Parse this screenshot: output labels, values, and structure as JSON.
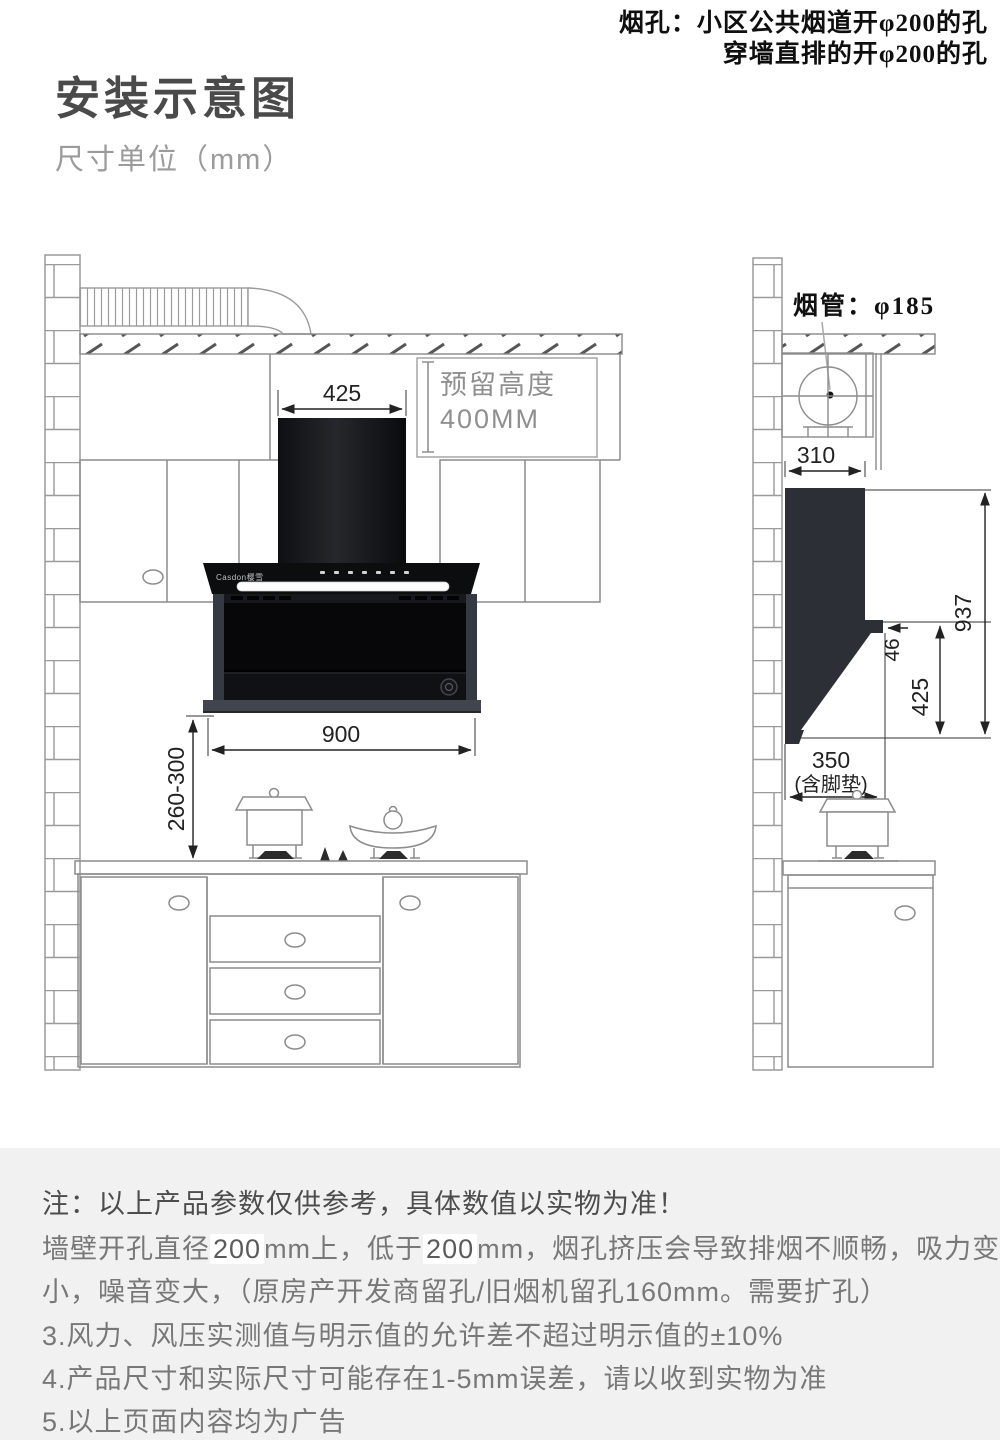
{
  "header": {
    "corner_note_line1": "烟孔：小区公共烟道开φ200的孔",
    "corner_note_line2": "穿墙直排的开φ200的孔",
    "title": "安装示意图",
    "subtitle": "尺寸单位（mm）"
  },
  "front_view": {
    "dim_chimney_width": "425",
    "reserved_height_line1": "预留高度",
    "reserved_height_line2": "400MM",
    "dim_hood_width": "900",
    "dim_install_height": "260-300",
    "brand": "Casdon樱雪"
  },
  "side_view": {
    "pipe_label": "烟管：φ185",
    "dim_top_depth": "310",
    "dim_total_height": "937",
    "dim_lip_depth": "46",
    "dim_lower_height": "425",
    "dim_bottom_depth": "350",
    "dim_bottom_depth_note": "(含脚垫)"
  },
  "notes": {
    "line1": "注：以上产品参数仅供参考，具体数值以实物为准！",
    "line2_part1": "墙壁开孔直径",
    "line2_highlight1": "200",
    "line2_part2": "mm上，低于",
    "line2_highlight2": "200",
    "line2_part3": "mm，烟孔挤压会导致排烟不顺畅，吸力变",
    "line3": "小，噪音变大，（原房产开发商留孔/旧烟机留孔160mm。需要扩孔）",
    "line4": "3.风力、风压实测值与明示值的允许差不超过明示值的±10%",
    "line5": "4.产品尺寸和实际尺寸可能存在1-5mm误差，请以收到实物为准",
    "line6": "5.以上页面内容均为广告"
  },
  "colors": {
    "hood_black": "#0b0c0e",
    "silhouette_gray": "#2c3036",
    "outline_gray": "#8c8c8c",
    "dimension_black": "#222222",
    "notes_background": "#f1f1f1",
    "reserved_text_gray": "#8f8f8f"
  }
}
